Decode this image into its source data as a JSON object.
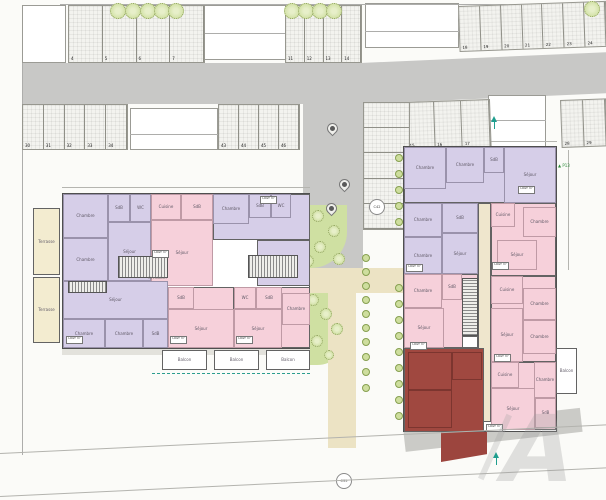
{
  "watermark": {
    "text": "A"
  },
  "colors": {
    "road": "#c8c8c6",
    "walk": "#e3e2dc",
    "walk2": "#cbcbc7",
    "green": "#cfe0a2",
    "path": "#ece3c4",
    "purple": "#d6cee8",
    "pink": "#f6d0da",
    "red": "#a04840",
    "red2": "#9c453e",
    "cream": "#f3ecd0",
    "cream2": "#efe6cd",
    "white": "#ffffff",
    "lineGray": "#adadab",
    "dim": "#b5b5b0"
  },
  "ubox_lines": [
    "LOGT",
    "m²"
  ],
  "rects": [
    {
      "name": "road-top-left",
      "x": 22,
      "y": 63,
      "w": 343,
      "h": 41,
      "f": "road"
    },
    {
      "name": "road-top-right",
      "x": 360,
      "y": 63,
      "w": 250,
      "h": 41,
      "f": "road",
      "rot": -2.5
    },
    {
      "name": "road-center",
      "x": 303,
      "y": 100,
      "w": 60,
      "h": 170,
      "f": "road"
    },
    {
      "name": "garden-upper",
      "x": 303,
      "y": 205,
      "w": 44,
      "h": 63,
      "f": "green",
      "br": "0 0 36px 0"
    },
    {
      "name": "path-horizontal",
      "x": 303,
      "y": 268,
      "w": 102,
      "h": 25,
      "f": "path"
    },
    {
      "name": "garden-lower",
      "x": 303,
      "y": 293,
      "w": 44,
      "h": 72,
      "f": "green",
      "br": "0 0 30px 0"
    },
    {
      "name": "path-vertical",
      "x": 328,
      "y": 293,
      "w": 28,
      "h": 155,
      "f": "path"
    },
    {
      "name": "sidewalk-left-building",
      "x": 62,
      "y": 348,
      "w": 248,
      "h": 7,
      "f": "walk"
    },
    {
      "name": "sidewalk-right-building",
      "x": 403,
      "y": 428,
      "w": 178,
      "h": 24,
      "f": "walk2",
      "rot": -6.5
    },
    {
      "name": "red-unit-terrace",
      "x": 441,
      "y": 406,
      "w": 46,
      "h": 56,
      "f": "red2",
      "clip": "polygon(0 16%, 100% 4%, 100% 86%, 0 100%)"
    },
    {
      "name": "neighbor-building",
      "x": 22,
      "y": 5,
      "w": 44,
      "h": 58,
      "f": "white",
      "bd": 1
    },
    {
      "name": "neighbor-building",
      "x": 200,
      "y": 5,
      "w": 86,
      "h": 55,
      "f": "white",
      "bd": 1
    },
    {
      "name": "neighbor-building",
      "x": 365,
      "y": 3,
      "w": 94,
      "h": 45,
      "f": "white",
      "bd": 1
    },
    {
      "name": "neighbor-building",
      "x": 130,
      "y": 108,
      "w": 88,
      "h": 42,
      "f": "white",
      "bd": 1
    },
    {
      "name": "entrance-block",
      "x": 488,
      "y": 95,
      "w": 58,
      "h": 53,
      "f": "white",
      "bd": 1
    },
    {
      "name": "neighbor-line",
      "x": 200,
      "y": 33,
      "w": 86,
      "h": 1,
      "f": "lineGray"
    },
    {
      "name": "neighbor-line",
      "x": 365,
      "y": 31,
      "w": 94,
      "h": 1,
      "f": "lineGray"
    },
    {
      "name": "neighbor-line",
      "x": 130,
      "y": 134,
      "w": 88,
      "h": 1,
      "f": "lineGray"
    },
    {
      "name": "neighbor-line",
      "x": 488,
      "y": 120,
      "w": 58,
      "h": 1,
      "f": "lineGray"
    },
    {
      "name": "boundary-left",
      "x": 22,
      "y": 63,
      "w": 1,
      "h": 392,
      "f": "lineGray"
    },
    {
      "name": "boundary-top",
      "x": 60,
      "y": 4,
      "w": 546,
      "h": 1,
      "f": "lineGray"
    },
    {
      "name": "dim-line",
      "x": 62,
      "y": 187,
      "w": 248,
      "h": 1,
      "f": "dim"
    },
    {
      "name": "dim-line",
      "x": 403,
      "y": 141,
      "w": 154,
      "h": 1,
      "f": "dim"
    },
    {
      "name": "dim-line",
      "x": 568,
      "y": 150,
      "w": 1,
      "h": 120,
      "f": "dim"
    }
  ],
  "buildings": [
    {
      "name": "left-building",
      "x": 62,
      "y": 193,
      "w": 248,
      "h": 156
    },
    {
      "name": "right-building",
      "x": 403,
      "y": 146,
      "w": 154,
      "h": 286
    }
  ],
  "rooms": [
    {
      "x": 63,
      "y": 194,
      "w": 88,
      "h": 87,
      "f": "purple"
    },
    {
      "x": 63,
      "y": 194,
      "w": 45,
      "h": 44,
      "f": "purple",
      "l": "Chambre",
      "s": 1
    },
    {
      "x": 108,
      "y": 194,
      "w": 22,
      "h": 28,
      "f": "purple",
      "l": "SdB",
      "s": 1
    },
    {
      "x": 130,
      "y": 194,
      "w": 21,
      "h": 28,
      "f": "purple",
      "l": "WC",
      "s": 1
    },
    {
      "x": 63,
      "y": 238,
      "w": 45,
      "h": 43,
      "f": "purple",
      "l": "Chambre",
      "s": 1
    },
    {
      "x": 108,
      "y": 222,
      "w": 43,
      "h": 59,
      "f": "purple",
      "l": "Séjour",
      "s": 1
    },
    {
      "x": 151,
      "y": 194,
      "w": 62,
      "h": 92,
      "f": "pink"
    },
    {
      "x": 151,
      "y": 194,
      "w": 30,
      "h": 26,
      "f": "pink",
      "l": "Cuisine",
      "s": 1
    },
    {
      "x": 181,
      "y": 194,
      "w": 32,
      "h": 26,
      "f": "pink",
      "l": "SdB",
      "s": 1
    },
    {
      "x": 151,
      "y": 220,
      "w": 62,
      "h": 66,
      "f": "pink",
      "l": "Séjour",
      "s": 1
    },
    {
      "x": 213,
      "y": 194,
      "w": 97,
      "h": 46,
      "f": "purple"
    },
    {
      "x": 213,
      "y": 194,
      "w": 36,
      "h": 30,
      "f": "purple",
      "l": "Chambre",
      "s": 1
    },
    {
      "x": 249,
      "y": 194,
      "w": 22,
      "h": 24,
      "f": "purple",
      "l": "SdB",
      "s": 1
    },
    {
      "x": 271,
      "y": 194,
      "w": 20,
      "h": 24,
      "f": "purple",
      "l": "WC",
      "s": 1
    },
    {
      "x": 257,
      "y": 240,
      "w": 53,
      "h": 46,
      "f": "purple",
      "l": "Séjour"
    },
    {
      "x": 63,
      "y": 281,
      "w": 105,
      "h": 67,
      "f": "purple"
    },
    {
      "x": 63,
      "y": 281,
      "w": 105,
      "h": 38,
      "f": "purple",
      "l": "Séjour",
      "s": 1
    },
    {
      "x": 63,
      "y": 319,
      "w": 42,
      "h": 29,
      "f": "purple",
      "l": "Chambre",
      "s": 1
    },
    {
      "x": 105,
      "y": 319,
      "w": 38,
      "h": 29,
      "f": "purple",
      "l": "Chambre",
      "s": 1
    },
    {
      "x": 143,
      "y": 319,
      "w": 25,
      "h": 29,
      "f": "purple",
      "l": "SdB",
      "s": 1
    },
    {
      "x": 168,
      "y": 287,
      "w": 66,
      "h": 61,
      "f": "pink"
    },
    {
      "x": 168,
      "y": 287,
      "w": 26,
      "h": 22,
      "f": "pink",
      "l": "SdB",
      "s": 1
    },
    {
      "x": 168,
      "y": 309,
      "w": 66,
      "h": 39,
      "f": "pink",
      "l": "Séjour",
      "s": 1
    },
    {
      "x": 234,
      "y": 287,
      "w": 76,
      "h": 61,
      "f": "pink"
    },
    {
      "x": 234,
      "y": 287,
      "w": 22,
      "h": 22,
      "f": "pink",
      "l": "WC",
      "s": 1
    },
    {
      "x": 256,
      "y": 287,
      "w": 26,
      "h": 22,
      "f": "pink",
      "l": "SdB",
      "s": 1
    },
    {
      "x": 282,
      "y": 293,
      "w": 28,
      "h": 32,
      "f": "pink",
      "l": "Chambre",
      "s": 1
    },
    {
      "x": 234,
      "y": 309,
      "w": 48,
      "h": 39,
      "f": "pink",
      "l": "Séjour",
      "s": 1
    },
    {
      "x": 33,
      "y": 208,
      "w": 27,
      "h": 67,
      "f": "cream",
      "l": "Terrasse"
    },
    {
      "x": 33,
      "y": 277,
      "w": 27,
      "h": 66,
      "f": "cream",
      "l": "Terrasse"
    },
    {
      "x": 162,
      "y": 350,
      "w": 45,
      "h": 20,
      "f": "white",
      "l": "Balcon"
    },
    {
      "x": 214,
      "y": 350,
      "w": 45,
      "h": 20,
      "f": "white",
      "l": "Balcon"
    },
    {
      "x": 266,
      "y": 350,
      "w": 44,
      "h": 20,
      "f": "white",
      "l": "Balcon"
    },
    {
      "x": 404,
      "y": 147,
      "w": 152,
      "h": 56,
      "f": "purple"
    },
    {
      "x": 404,
      "y": 147,
      "w": 42,
      "h": 42,
      "f": "purple",
      "l": "Chambre",
      "s": 1
    },
    {
      "x": 446,
      "y": 147,
      "w": 38,
      "h": 36,
      "f": "purple",
      "l": "Chambre",
      "s": 1
    },
    {
      "x": 484,
      "y": 147,
      "w": 20,
      "h": 26,
      "f": "purple",
      "l": "SdB",
      "s": 1
    },
    {
      "x": 504,
      "y": 147,
      "w": 52,
      "h": 56,
      "f": "purple",
      "l": "Séjour",
      "s": 1
    },
    {
      "x": 404,
      "y": 203,
      "w": 74,
      "h": 71,
      "f": "purple"
    },
    {
      "x": 404,
      "y": 203,
      "w": 38,
      "h": 34,
      "f": "purple",
      "l": "Chambre",
      "s": 1
    },
    {
      "x": 404,
      "y": 237,
      "w": 38,
      "h": 37,
      "f": "purple",
      "l": "Chambre",
      "s": 1
    },
    {
      "x": 442,
      "y": 203,
      "w": 36,
      "h": 30,
      "f": "purple",
      "l": "SdB",
      "s": 1
    },
    {
      "x": 442,
      "y": 233,
      "w": 36,
      "h": 41,
      "f": "purple",
      "l": "Séjour",
      "s": 1
    },
    {
      "x": 478,
      "y": 203,
      "w": 13,
      "h": 219,
      "f": "cream2"
    },
    {
      "x": 491,
      "y": 203,
      "w": 65,
      "h": 73,
      "f": "pink"
    },
    {
      "x": 491,
      "y": 203,
      "w": 24,
      "h": 24,
      "f": "pink",
      "l": "Cuisine",
      "s": 1
    },
    {
      "x": 523,
      "y": 207,
      "w": 33,
      "h": 30,
      "f": "pink",
      "l": "Chambre",
      "s": 1
    },
    {
      "x": 497,
      "y": 240,
      "w": 40,
      "h": 30,
      "f": "pink",
      "l": "Séjour",
      "s": 1
    },
    {
      "x": 404,
      "y": 274,
      "w": 74,
      "h": 74,
      "f": "pink"
    },
    {
      "x": 404,
      "y": 274,
      "w": 38,
      "h": 34,
      "f": "pink",
      "l": "Chambre",
      "s": 1
    },
    {
      "x": 442,
      "y": 274,
      "w": 20,
      "h": 26,
      "f": "pink",
      "l": "SdB",
      "s": 1
    },
    {
      "x": 404,
      "y": 308,
      "w": 40,
      "h": 40,
      "f": "pink",
      "l": "Séjour",
      "s": 1
    },
    {
      "x": 491,
      "y": 276,
      "w": 65,
      "h": 86,
      "f": "pink"
    },
    {
      "x": 491,
      "y": 276,
      "w": 32,
      "h": 28,
      "f": "pink",
      "l": "Cuisine",
      "s": 1
    },
    {
      "x": 523,
      "y": 288,
      "w": 33,
      "h": 32,
      "f": "pink",
      "l": "Chambre",
      "s": 1
    },
    {
      "x": 523,
      "y": 320,
      "w": 33,
      "h": 34,
      "f": "pink",
      "l": "Chambre",
      "s": 1
    },
    {
      "x": 491,
      "y": 308,
      "w": 32,
      "h": 54,
      "f": "pink",
      "l": "Séjour",
      "s": 1
    },
    {
      "x": 404,
      "y": 348,
      "w": 80,
      "h": 84,
      "f": "red"
    },
    {
      "x": 408,
      "y": 352,
      "w": 44,
      "h": 38,
      "f": "red",
      "s": 1
    },
    {
      "x": 408,
      "y": 390,
      "w": 44,
      "h": 38,
      "f": "red",
      "s": 1
    },
    {
      "x": 452,
      "y": 352,
      "w": 30,
      "h": 28,
      "f": "red",
      "s": 1
    },
    {
      "x": 491,
      "y": 362,
      "w": 65,
      "h": 68,
      "f": "pink"
    },
    {
      "x": 491,
      "y": 362,
      "w": 28,
      "h": 26,
      "f": "pink",
      "l": "Cuisine",
      "s": 1
    },
    {
      "x": 534,
      "y": 362,
      "w": 22,
      "h": 36,
      "f": "pink",
      "l": "Chambre",
      "s": 1
    },
    {
      "x": 535,
      "y": 398,
      "w": 21,
      "h": 30,
      "f": "pink",
      "l": "SdB",
      "s": 1
    },
    {
      "x": 491,
      "y": 388,
      "w": 44,
      "h": 42,
      "f": "pink",
      "l": "Séjour",
      "s": 1
    },
    {
      "x": 556,
      "y": 348,
      "w": 21,
      "h": 46,
      "f": "white",
      "l": "Balcon"
    },
    {
      "x": 462,
      "y": 336,
      "w": 16,
      "h": 12,
      "f": "white"
    }
  ],
  "stairs": [
    {
      "x": 118,
      "y": 256,
      "w": 50,
      "h": 22,
      "dir": "h"
    },
    {
      "x": 248,
      "y": 255,
      "w": 50,
      "h": 23,
      "dir": "h"
    },
    {
      "x": 68,
      "y": 281,
      "w": 39,
      "h": 12,
      "dir": "h"
    },
    {
      "x": 462,
      "y": 278,
      "w": 16,
      "h": 58,
      "dir": "v"
    }
  ],
  "stall_rows": [
    {
      "name": "stalls-4-7",
      "x": 68,
      "y": 5,
      "w": 137,
      "h": 58,
      "n": 4,
      "numbers": [
        "4",
        "5",
        "6",
        "7"
      ]
    },
    {
      "name": "stalls-11-14",
      "x": 285,
      "y": 5,
      "w": 77,
      "h": 58,
      "n": 4,
      "numbers": [
        "11",
        "12",
        "13",
        "14"
      ]
    },
    {
      "name": "stalls-18-24",
      "x": 458,
      "y": 6,
      "w": 148,
      "h": 46,
      "n": 7,
      "numbers": [
        "18",
        "19",
        "20",
        "21",
        "22",
        "23",
        "24"
      ],
      "rot": -2
    },
    {
      "name": "stalls-30-34",
      "x": 22,
      "y": 104,
      "w": 106,
      "h": 46,
      "n": 5,
      "numbers": [
        "30",
        "31",
        "32",
        "33",
        "34"
      ]
    },
    {
      "name": "stalls-43-46",
      "x": 218,
      "y": 104,
      "w": 82,
      "h": 46,
      "n": 4,
      "numbers": [
        "43",
        "44",
        "45",
        "46"
      ]
    },
    {
      "name": "stalls-15-17",
      "x": 405,
      "y": 102,
      "w": 85,
      "h": 48,
      "n": 3,
      "numbers": [
        "15",
        "16",
        "17"
      ],
      "rot": -2
    },
    {
      "name": "stalls-28-29",
      "x": 560,
      "y": 100,
      "w": 46,
      "h": 48,
      "n": 2,
      "numbers": [
        "28",
        "29"
      ],
      "rot": -2
    },
    {
      "name": "stalls-side",
      "x": 363,
      "y": 102,
      "w": 47,
      "h": 128,
      "n": 5,
      "numbers": [
        "",
        "",
        "",
        "",
        ""
      ],
      "dir": "v"
    }
  ],
  "trees": [
    {
      "x": 118,
      "y": 11,
      "r": 8,
      "t": "tree"
    },
    {
      "x": 133,
      "y": 11,
      "r": 8,
      "t": "tree"
    },
    {
      "x": 148,
      "y": 11,
      "r": 8,
      "t": "tree"
    },
    {
      "x": 162,
      "y": 11,
      "r": 8,
      "t": "tree"
    },
    {
      "x": 176,
      "y": 11,
      "r": 8,
      "t": "tree"
    },
    {
      "x": 292,
      "y": 11,
      "r": 8,
      "t": "tree"
    },
    {
      "x": 306,
      "y": 11,
      "r": 8,
      "t": "tree"
    },
    {
      "x": 320,
      "y": 11,
      "r": 8,
      "t": "tree"
    },
    {
      "x": 334,
      "y": 11,
      "r": 8,
      "t": "tree"
    },
    {
      "x": 592,
      "y": 9,
      "r": 8,
      "t": "tree"
    },
    {
      "x": 318,
      "y": 216,
      "r": 6,
      "t": "tree"
    },
    {
      "x": 334,
      "y": 231,
      "r": 6,
      "t": "tree"
    },
    {
      "x": 320,
      "y": 247,
      "r": 6,
      "t": "tree"
    },
    {
      "x": 308,
      "y": 261,
      "r": 6,
      "t": "tree"
    },
    {
      "x": 339,
      "y": 259,
      "r": 6,
      "t": "tree"
    },
    {
      "x": 313,
      "y": 300,
      "r": 6,
      "t": "tree"
    },
    {
      "x": 326,
      "y": 314,
      "r": 6,
      "t": "tree"
    },
    {
      "x": 337,
      "y": 329,
      "r": 6,
      "t": "tree"
    },
    {
      "x": 317,
      "y": 341,
      "r": 6,
      "t": "tree"
    },
    {
      "x": 329,
      "y": 355,
      "r": 5,
      "t": "tree"
    },
    {
      "x": 366,
      "y": 258,
      "r": 4,
      "t": "shrub"
    },
    {
      "x": 366,
      "y": 272,
      "r": 4,
      "t": "shrub"
    },
    {
      "x": 366,
      "y": 286,
      "r": 4,
      "t": "shrub"
    },
    {
      "x": 366,
      "y": 300,
      "r": 4,
      "t": "shrub"
    },
    {
      "x": 366,
      "y": 314,
      "r": 4,
      "t": "shrub"
    },
    {
      "x": 366,
      "y": 328,
      "r": 4,
      "t": "shrub"
    },
    {
      "x": 366,
      "y": 342,
      "r": 4,
      "t": "shrub"
    },
    {
      "x": 366,
      "y": 357,
      "r": 4,
      "t": "shrub"
    },
    {
      "x": 366,
      "y": 372,
      "r": 4,
      "t": "shrub"
    },
    {
      "x": 366,
      "y": 388,
      "r": 4,
      "t": "shrub"
    },
    {
      "x": 399,
      "y": 158,
      "r": 4,
      "t": "shrub"
    },
    {
      "x": 399,
      "y": 174,
      "r": 4,
      "t": "shrub"
    },
    {
      "x": 399,
      "y": 190,
      "r": 4,
      "t": "shrub"
    },
    {
      "x": 399,
      "y": 206,
      "r": 4,
      "t": "shrub"
    },
    {
      "x": 399,
      "y": 222,
      "r": 4,
      "t": "shrub"
    },
    {
      "x": 399,
      "y": 288,
      "r": 4,
      "t": "shrub"
    },
    {
      "x": 399,
      "y": 304,
      "r": 4,
      "t": "shrub"
    },
    {
      "x": 399,
      "y": 320,
      "r": 4,
      "t": "shrub"
    },
    {
      "x": 399,
      "y": 336,
      "r": 4,
      "t": "shrub"
    },
    {
      "x": 399,
      "y": 352,
      "r": 4,
      "t": "shrub"
    },
    {
      "x": 399,
      "y": 368,
      "r": 4,
      "t": "shrub"
    },
    {
      "x": 399,
      "y": 384,
      "r": 4,
      "t": "shrub"
    },
    {
      "x": 399,
      "y": 400,
      "r": 4,
      "t": "shrub"
    },
    {
      "x": 399,
      "y": 416,
      "r": 4,
      "t": "shrub"
    }
  ],
  "markers": {
    "pins": [
      {
        "x": 332,
        "y": 128
      },
      {
        "x": 344,
        "y": 184
      },
      {
        "x": 331,
        "y": 208
      }
    ],
    "circles": [
      {
        "x": 377,
        "y": 207,
        "label": "C42"
      },
      {
        "x": 344,
        "y": 481,
        "label": "C35"
      }
    ],
    "arrows": [
      {
        "x": 494,
        "y": 116
      },
      {
        "x": 496,
        "y": 452
      }
    ],
    "plabels": [
      {
        "x": 558,
        "y": 163,
        "text": "P13"
      }
    ]
  },
  "texts": [
    {
      "x": 148,
      "y": 277,
      "text": "Circulation",
      "size": 3.5
    }
  ],
  "uboxes": [
    {
      "x": 66,
      "y": 336
    },
    {
      "x": 170,
      "y": 336
    },
    {
      "x": 236,
      "y": 336
    },
    {
      "x": 152,
      "y": 250
    },
    {
      "x": 260,
      "y": 196
    },
    {
      "x": 518,
      "y": 186
    },
    {
      "x": 406,
      "y": 264
    },
    {
      "x": 492,
      "y": 262
    },
    {
      "x": 494,
      "y": 354
    },
    {
      "x": 486,
      "y": 424
    },
    {
      "x": 410,
      "y": 342
    }
  ],
  "lines": [
    {
      "x": 0,
      "y": 453,
      "w": 610,
      "rot": -2.7,
      "cls": "roadline",
      "name": "road-edge-line"
    },
    {
      "x": 0,
      "y": 496,
      "w": 610,
      "rot": -2.7,
      "cls": "roadline",
      "name": "road-edge-line"
    },
    {
      "x": 152,
      "y": 373,
      "w": 158,
      "rot": 0,
      "cls": "teal-dash",
      "name": "limit-dashed-line"
    }
  ]
}
